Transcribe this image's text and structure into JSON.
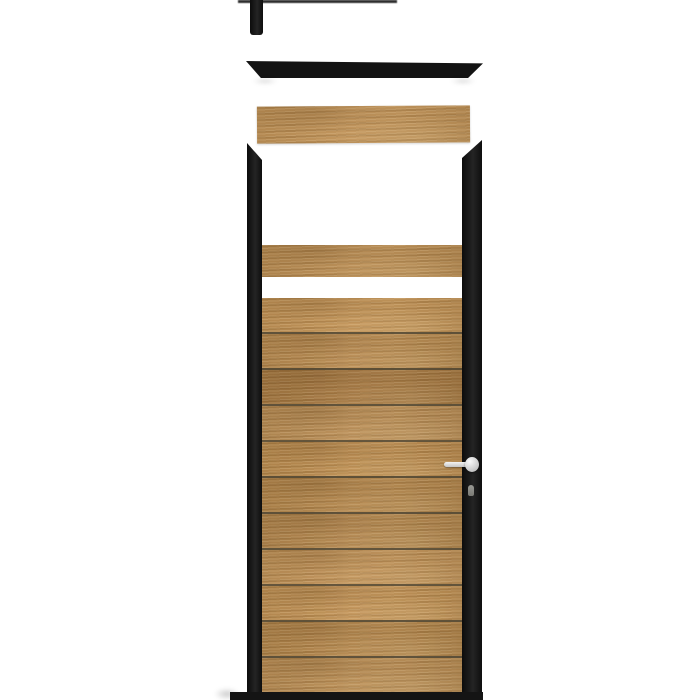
{
  "image": {
    "description": "Exploded product view of a black-framed garden gate/door with horizontal oak wood slats, detached top cap rail, loose plank, lever handle and bottom base bar on a white background",
    "background_color": "#ffffff"
  },
  "palette": {
    "background": "#ffffff",
    "frame-black": "#141414",
    "wood-base": "#b5874d",
    "wood-light": "#c79a5f",
    "wood-dark": "#a4793f",
    "seam": "#544a36",
    "handle-silver": "#d8d8d8"
  },
  "parts": {
    "top_bracket": {
      "label": "wall bracket (cropped at top edge)"
    },
    "top_cap_rail": {
      "label": "detached black top cap rail"
    },
    "loose_plank": {
      "label": "loose oak plank",
      "color": "#c09257"
    },
    "frame": {
      "left_rail": "left frame rail (mitred top)",
      "right_rail": "right frame rail (mitred top)"
    },
    "fixed_plank": {
      "label": "upper fixed oak plank",
      "color": "#b98c52"
    },
    "slats": {
      "label": "horizontal oak slats",
      "count": 11,
      "colors": [
        "#b98c52",
        "#b78a50",
        "#ad8049",
        "#b98d55",
        "#b3864c",
        "#bb8e54",
        "#b6894f",
        "#c09258",
        "#b88b51",
        "#b2854b",
        "#bd9056"
      ]
    },
    "handle": {
      "label": "silver lever door handle",
      "keyhole": true
    },
    "base_bar": {
      "label": "black bottom base bar"
    }
  }
}
